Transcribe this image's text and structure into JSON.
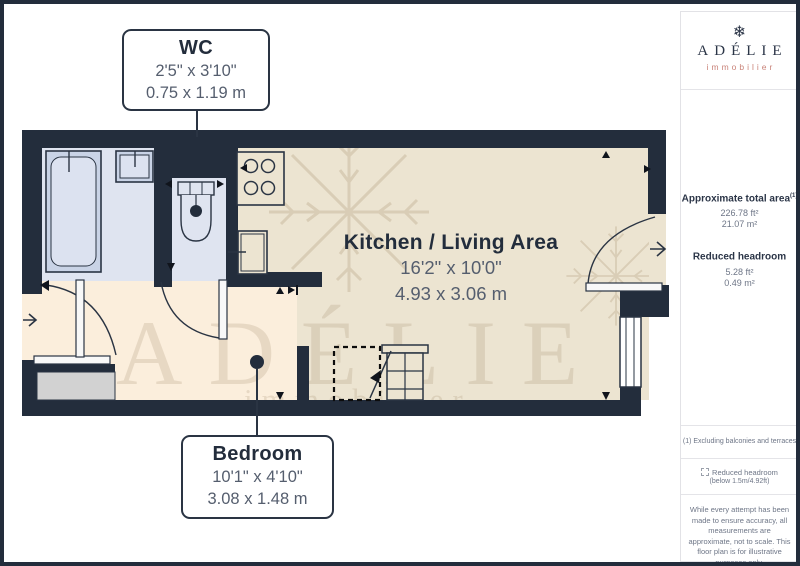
{
  "rooms": {
    "wc": {
      "name": "WC",
      "imperial": "2'5\" x 3'10\"",
      "metric": "0.75 x 1.19 m"
    },
    "kitchen_living": {
      "name": "Kitchen / Living Area",
      "imperial": "16'2\" x 10'0\"",
      "metric": "4.93 x 3.06 m"
    },
    "bedroom": {
      "name": "Bedroom",
      "imperial": "10'1\" x 4'10\"",
      "metric": "3.08 x 1.48 m"
    }
  },
  "watermark": {
    "text": "ADÉLIE",
    "subtext": "immobilier"
  },
  "sidebar": {
    "brand": {
      "name": "ADÉLIE",
      "tagline": "immobilier",
      "icon": "snowflake"
    },
    "stats": [
      {
        "label": "Approximate total area",
        "sup": "(1)",
        "values": [
          "226.78 ft²",
          "21.07 m²"
        ]
      },
      {
        "label": "Reduced headroom",
        "sup": "",
        "values": [
          "5.28 ft²",
          "0.49 m²"
        ]
      }
    ],
    "footnote": "(1) Excluding balconies and terraces",
    "legend": {
      "label": "Reduced headroom",
      "sublabel": "(below 1.5m/4.92ft)"
    },
    "disclaimer": "While every attempt has been made to ensure accuracy, all measurements are approximate, not to scale. This floor plan is for illustrative purposes only.",
    "brand_footer": {
      "name": "GIRAFFE",
      "suffix": "360"
    }
  },
  "colors": {
    "wall": "#232d3c",
    "floor_living": "#ece4d1",
    "floor_bedroom": "#fbeedc",
    "floor_bathroom": "#dfe4f0",
    "accent": "#c98379",
    "text_dark": "#232d3c",
    "text_gray": "#5a6372"
  }
}
